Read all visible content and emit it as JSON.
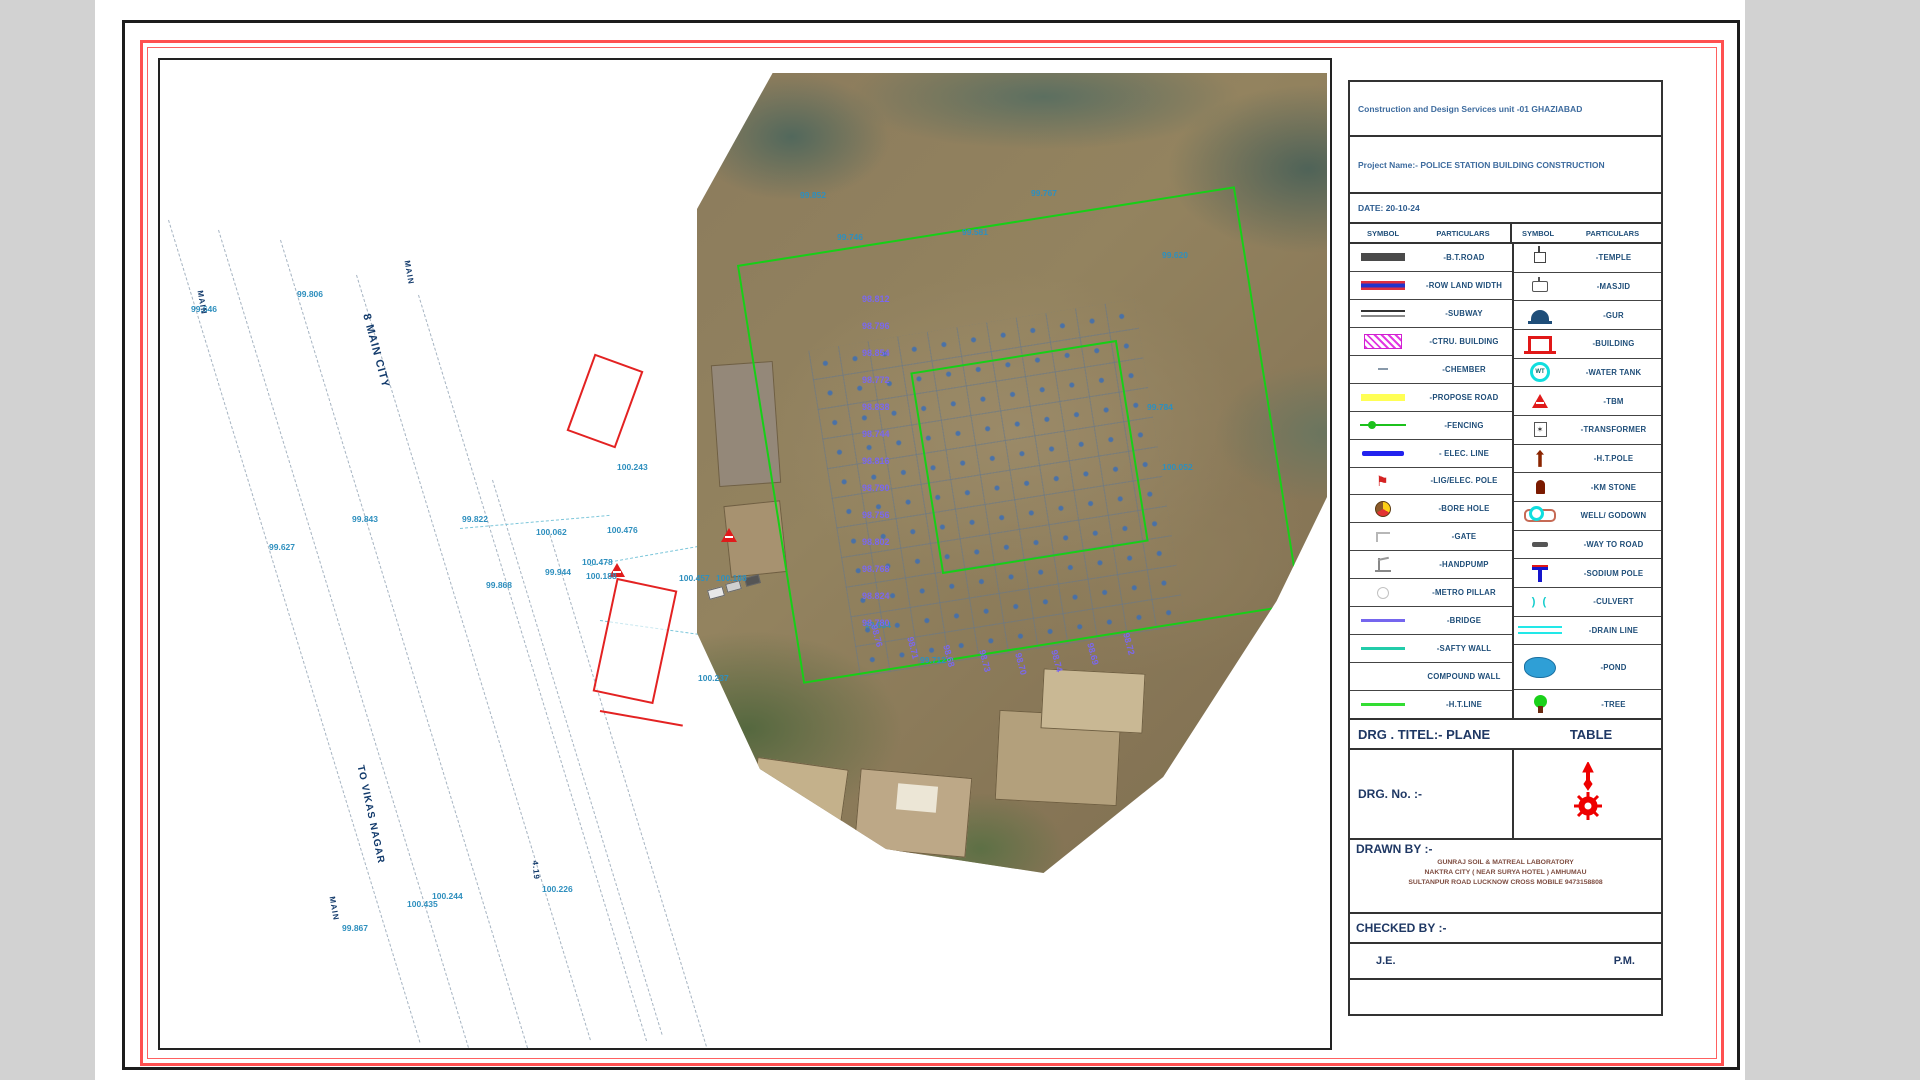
{
  "title_block": {
    "org": "Construction and Design Services unit -01 GHAZIABAD",
    "project": "Project Name:- POLICE STATION BUILDING CONSTRUCTION",
    "date": "DATE: 20-10-24"
  },
  "legend": {
    "headers": [
      "SYMBOL",
      "PARTICULARS",
      "SYMBOL",
      "PARTICULARS"
    ],
    "left": [
      {
        "symbol": "bt-road",
        "label": "-B.T.ROAD"
      },
      {
        "symbol": "row-land-width",
        "label": "-ROW LAND WIDTH"
      },
      {
        "symbol": "subway",
        "label": "-SUBWAY"
      },
      {
        "symbol": "ctru-building",
        "label": "-CTRU. BUILDING"
      },
      {
        "symbol": "chember",
        "label": "-CHEMBER"
      },
      {
        "symbol": "propose-road",
        "label": "-PROPOSE ROAD"
      },
      {
        "symbol": "fencing",
        "label": "-FENCING"
      },
      {
        "symbol": "elec-line",
        "label": "- ELEC. LINE"
      },
      {
        "symbol": "elec-pole",
        "label": "-LIG/ELEC. POLE"
      },
      {
        "symbol": "bore-hole",
        "label": "-BORE HOLE"
      },
      {
        "symbol": "gate",
        "label": "-GATE"
      },
      {
        "symbol": "handpump",
        "label": "-HANDPUMP"
      },
      {
        "symbol": "metro-pillar",
        "label": "-METRO PILLAR"
      },
      {
        "symbol": "bridge",
        "label": "-BRIDGE"
      },
      {
        "symbol": "safty-wall",
        "label": "-SAFTY WALL"
      },
      {
        "symbol": "compound-wall",
        "label": "COMPOUND WALL"
      },
      {
        "symbol": "ht-line",
        "label": "-H.T.LINE"
      }
    ],
    "right": [
      {
        "symbol": "temple",
        "label": "-TEMPLE"
      },
      {
        "symbol": "masjid",
        "label": "-MASJID"
      },
      {
        "symbol": "gur",
        "label": "-GUR"
      },
      {
        "symbol": "building",
        "label": "-BUILDING"
      },
      {
        "symbol": "water-tank",
        "label": "-WATER TANK"
      },
      {
        "symbol": "tbm",
        "label": "-TBM"
      },
      {
        "symbol": "transformer",
        "label": "-TRANSFORMER"
      },
      {
        "symbol": "ht-pole",
        "label": "-H.T.POLE"
      },
      {
        "symbol": "km-stone",
        "label": "-KM STONE"
      },
      {
        "symbol": "well-godown",
        "label": "WELL/ GODOWN"
      },
      {
        "symbol": "way-to-road",
        "label": "-WAY TO ROAD"
      },
      {
        "symbol": "sodium-pole",
        "label": "-SODIUM POLE"
      },
      {
        "symbol": "culvert",
        "label": "-CULVERT"
      },
      {
        "symbol": "drain-line",
        "label": "-DRAIN LINE"
      },
      {
        "symbol": "pond",
        "label": "-POND",
        "tall": true
      },
      {
        "symbol": "tree",
        "label": "-TREE"
      }
    ]
  },
  "drawing_info": {
    "title_left": "DRG . TITEL:- PLANE",
    "title_right": "TABLE",
    "drg_no_label": "DRG. No. :-",
    "drawn_by_label": "DRAWN BY :-",
    "drawn_by_lines": [
      "GUNRAJ SOIL & MATREAL LABORATORY",
      "NAKTRA CITY ( NEAR SURYA HOTEL ) AMHUMAU",
      "SULTANPUR ROAD LUCKNOW CROSS MOBILE 9473158808"
    ],
    "checked_by_label": "CHECKED BY :-",
    "je": "J.E.",
    "pm": "P.M."
  },
  "map": {
    "colors": {
      "boundary_green": "#17cf17",
      "elevation_cyan": "#2e8fbe",
      "elevation_purple": "#7b68ee",
      "label_navy": "#123a6b",
      "tbm_red": "#e01b1b"
    },
    "road_labels": [
      {
        "text": "8 MAIN CITY",
        "x": 206,
        "y": 248,
        "rot": 75,
        "size": 11
      },
      {
        "text": "TO VIKAS NAGAR",
        "x": 200,
        "y": 700,
        "rot": 78,
        "size": 10
      },
      {
        "text": "MAIN",
        "x": 247,
        "y": 196,
        "rot": 80,
        "size": 8
      },
      {
        "text": "MAIN",
        "x": 40,
        "y": 226,
        "rot": 80,
        "size": 8
      },
      {
        "text": "MAIN",
        "x": 172,
        "y": 832,
        "rot": 80,
        "size": 8
      },
      {
        "text": "4.19",
        "x": 375,
        "y": 796,
        "rot": 85,
        "size": 8
      }
    ],
    "elevations_cyan": [
      {
        "x": 137,
        "y": 229,
        "v": "99.806"
      },
      {
        "x": 31,
        "y": 244,
        "v": "99.646"
      },
      {
        "x": 109,
        "y": 482,
        "v": "99.627"
      },
      {
        "x": 457,
        "y": 402,
        "v": "100.243"
      },
      {
        "x": 376,
        "y": 467,
        "v": "100.062"
      },
      {
        "x": 447,
        "y": 465,
        "v": "100.476"
      },
      {
        "x": 302,
        "y": 454,
        "v": "99.822"
      },
      {
        "x": 192,
        "y": 454,
        "v": "99.843"
      },
      {
        "x": 422,
        "y": 497,
        "v": "100.478"
      },
      {
        "x": 326,
        "y": 520,
        "v": "99.868"
      },
      {
        "x": 426,
        "y": 511,
        "v": "100.188"
      },
      {
        "x": 385,
        "y": 507,
        "v": "99.944"
      },
      {
        "x": 538,
        "y": 613,
        "v": "100.237"
      },
      {
        "x": 272,
        "y": 831,
        "v": "100.244"
      },
      {
        "x": 247,
        "y": 839,
        "v": "100.435"
      },
      {
        "x": 182,
        "y": 863,
        "v": "99.867"
      },
      {
        "x": 382,
        "y": 824,
        "v": "100.226"
      },
      {
        "x": 519,
        "y": 513,
        "v": "100.457"
      },
      {
        "x": 556,
        "y": 513,
        "v": "100.188"
      },
      {
        "x": 677,
        "y": 172,
        "v": "99.746"
      },
      {
        "x": 802,
        "y": 167,
        "v": "99.581"
      },
      {
        "x": 1002,
        "y": 190,
        "v": "99.620"
      },
      {
        "x": 987,
        "y": 342,
        "v": "99.784"
      },
      {
        "x": 1002,
        "y": 402,
        "v": "100.052"
      },
      {
        "x": 705,
        "y": 560,
        "v": "99.634"
      },
      {
        "x": 760,
        "y": 595,
        "v": "99.712"
      },
      {
        "x": 640,
        "y": 130,
        "v": "99.852"
      },
      {
        "x": 871,
        "y": 128,
        "v": "99.767"
      }
    ],
    "elevations_purple": [
      {
        "x": 702,
        "y": 234,
        "v": "98.812"
      },
      {
        "x": 702,
        "y": 261,
        "v": "98.796"
      },
      {
        "x": 702,
        "y": 288,
        "v": "98.854"
      },
      {
        "x": 702,
        "y": 315,
        "v": "98.772"
      },
      {
        "x": 702,
        "y": 342,
        "v": "98.838"
      },
      {
        "x": 702,
        "y": 369,
        "v": "98.744"
      },
      {
        "x": 702,
        "y": 396,
        "v": "98.816"
      },
      {
        "x": 702,
        "y": 423,
        "v": "98.790"
      },
      {
        "x": 702,
        "y": 450,
        "v": "98.756"
      },
      {
        "x": 702,
        "y": 477,
        "v": "98.802"
      },
      {
        "x": 702,
        "y": 504,
        "v": "98.768"
      },
      {
        "x": 702,
        "y": 531,
        "v": "98.824"
      },
      {
        "x": 702,
        "y": 558,
        "v": "98.780"
      },
      {
        "x": 714,
        "y": 560,
        "v": "98.76",
        "rot": 75
      },
      {
        "x": 750,
        "y": 572,
        "v": "98.71",
        "rot": 75
      },
      {
        "x": 786,
        "y": 580,
        "v": "98.68",
        "rot": 75
      },
      {
        "x": 822,
        "y": 585,
        "v": "98.73",
        "rot": 75
      },
      {
        "x": 858,
        "y": 588,
        "v": "98.70",
        "rot": 75
      },
      {
        "x": 894,
        "y": 585,
        "v": "98.74",
        "rot": 75
      },
      {
        "x": 930,
        "y": 578,
        "v": "98.69",
        "rot": 75
      },
      {
        "x": 966,
        "y": 568,
        "v": "98.72",
        "rot": 75
      }
    ]
  }
}
